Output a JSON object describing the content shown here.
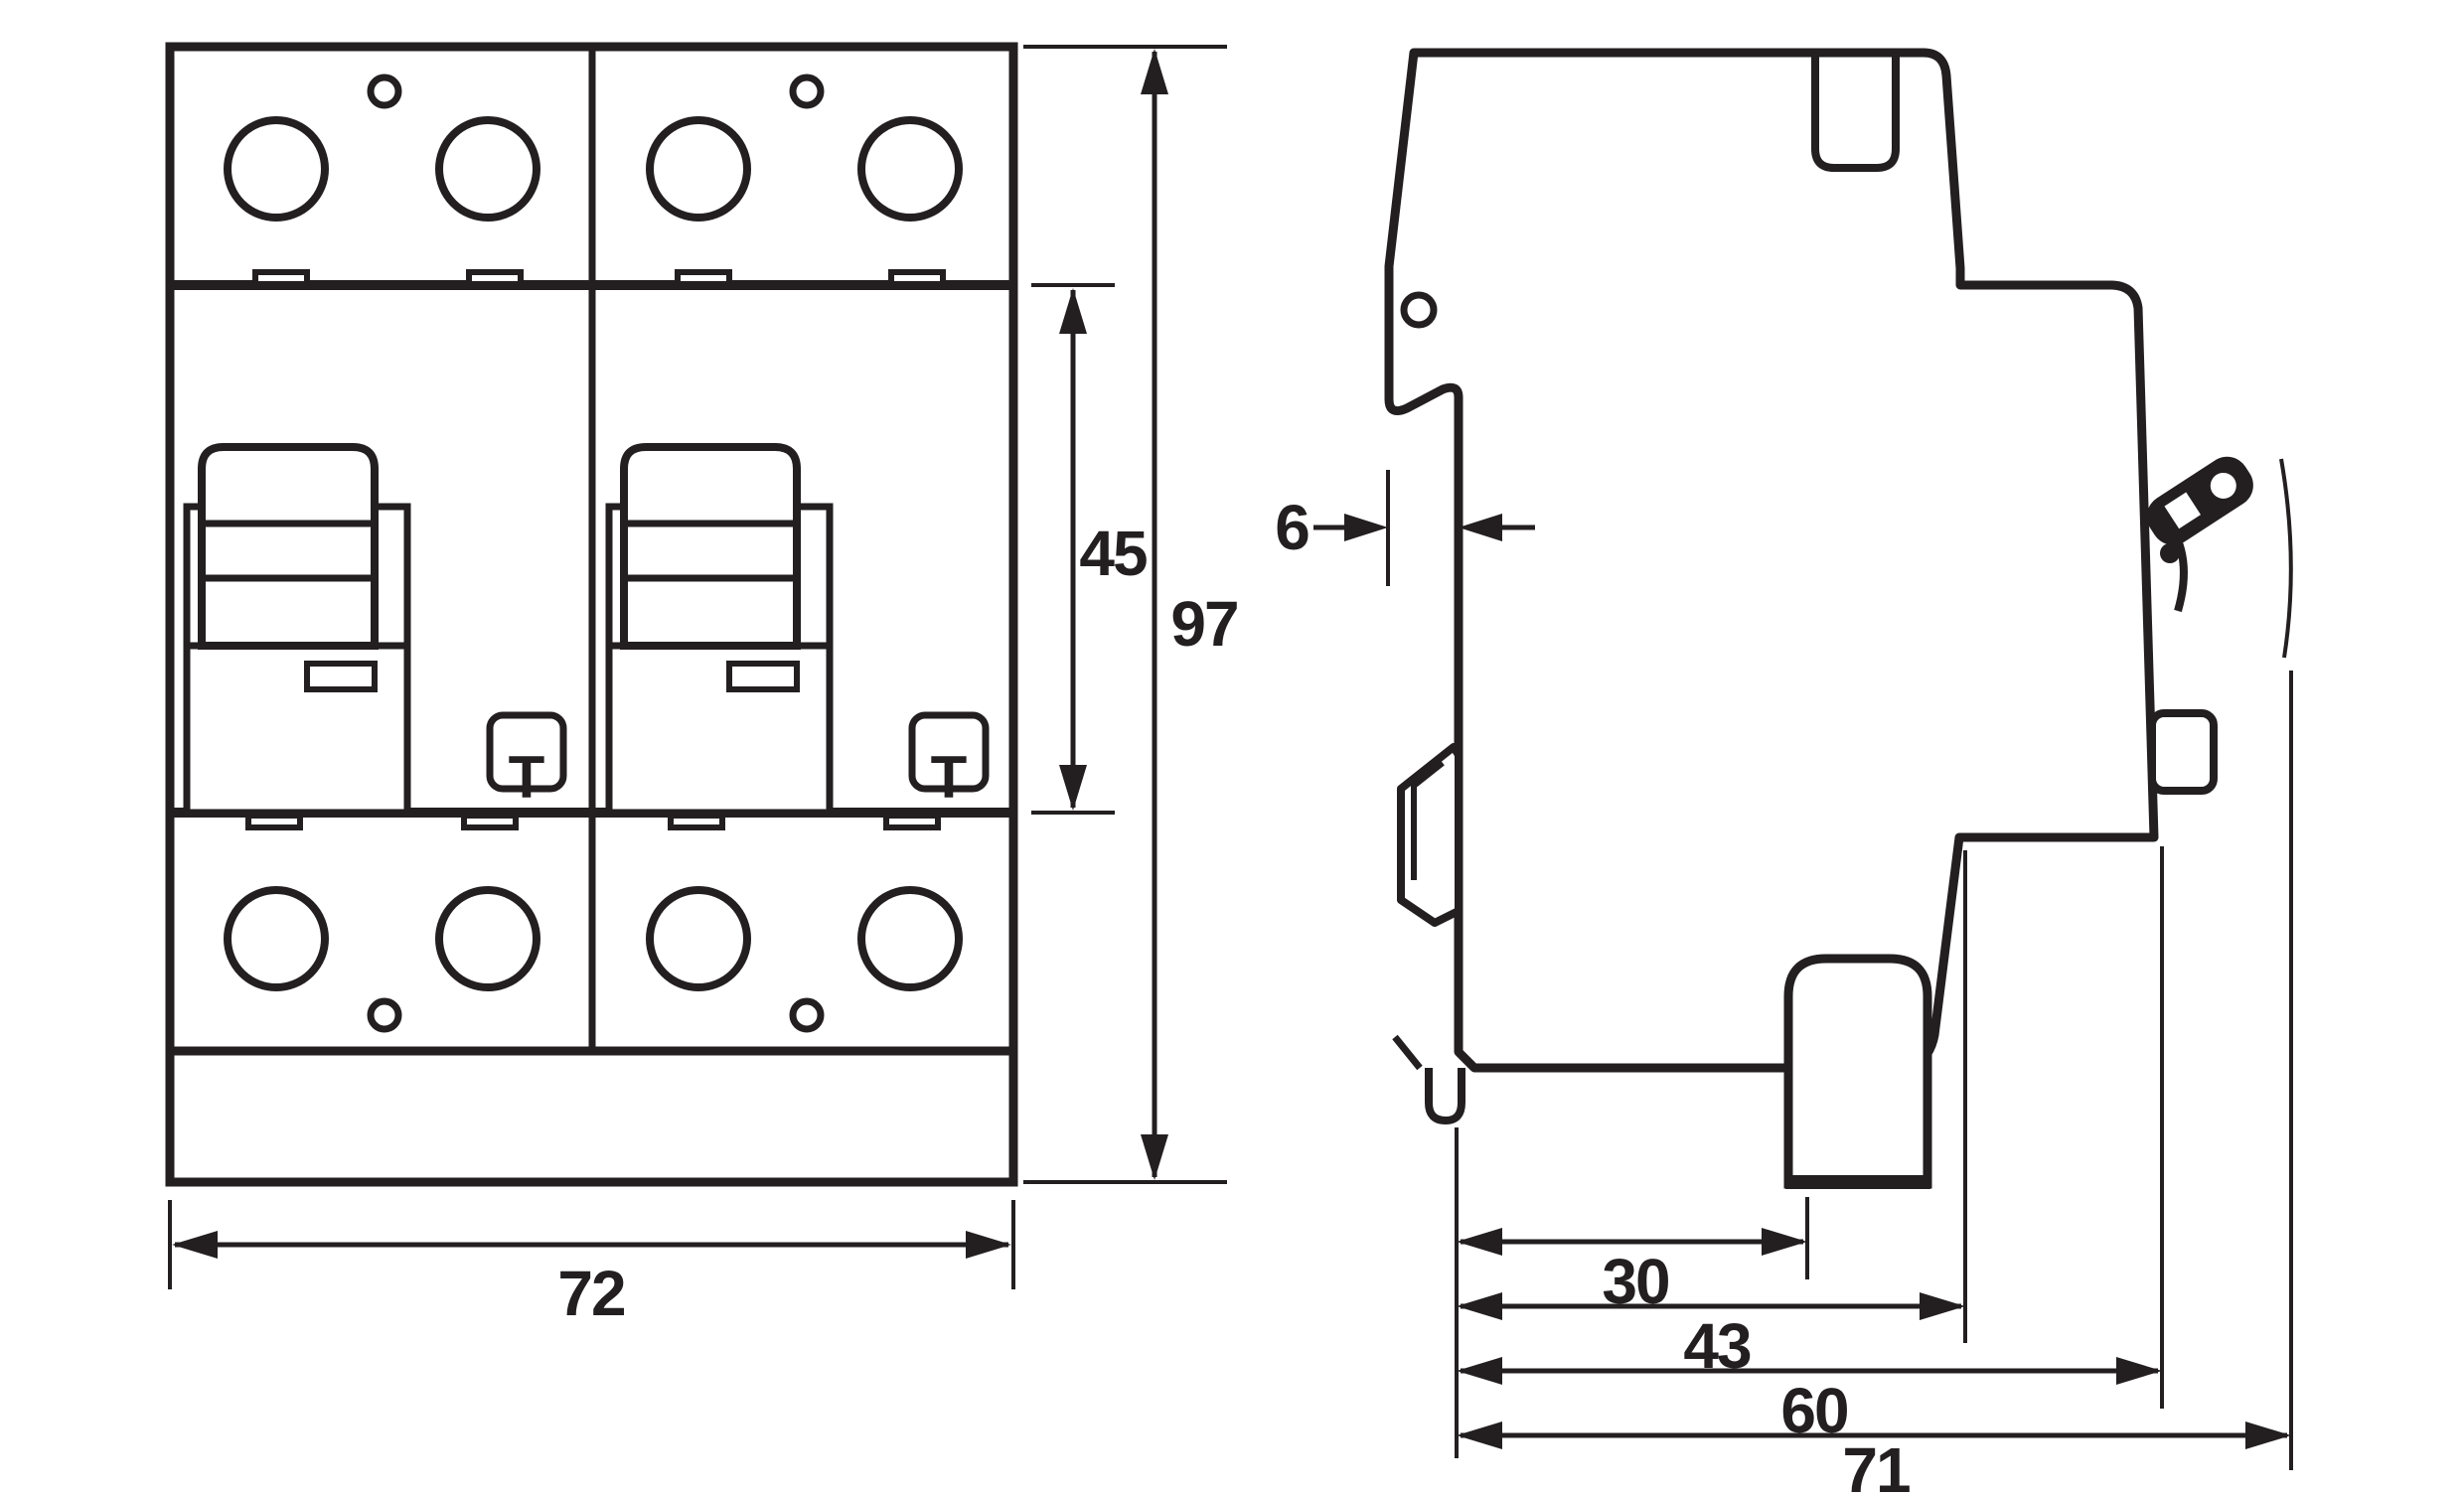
{
  "drawing": {
    "type": "technical-dimension-drawing",
    "views": {
      "left": "front-view",
      "right": "side-view"
    },
    "units": "mm",
    "colors": {
      "ink": "#231f20",
      "background": "#ffffff"
    }
  },
  "dimensions_mm": {
    "width": "72",
    "height": "97",
    "module_height": "45",
    "rail_recess": "6",
    "depth_30": "30",
    "depth_43": "43",
    "depth_60": "60",
    "depth_71": "71"
  },
  "front_view": {
    "test_button_label": "T"
  }
}
